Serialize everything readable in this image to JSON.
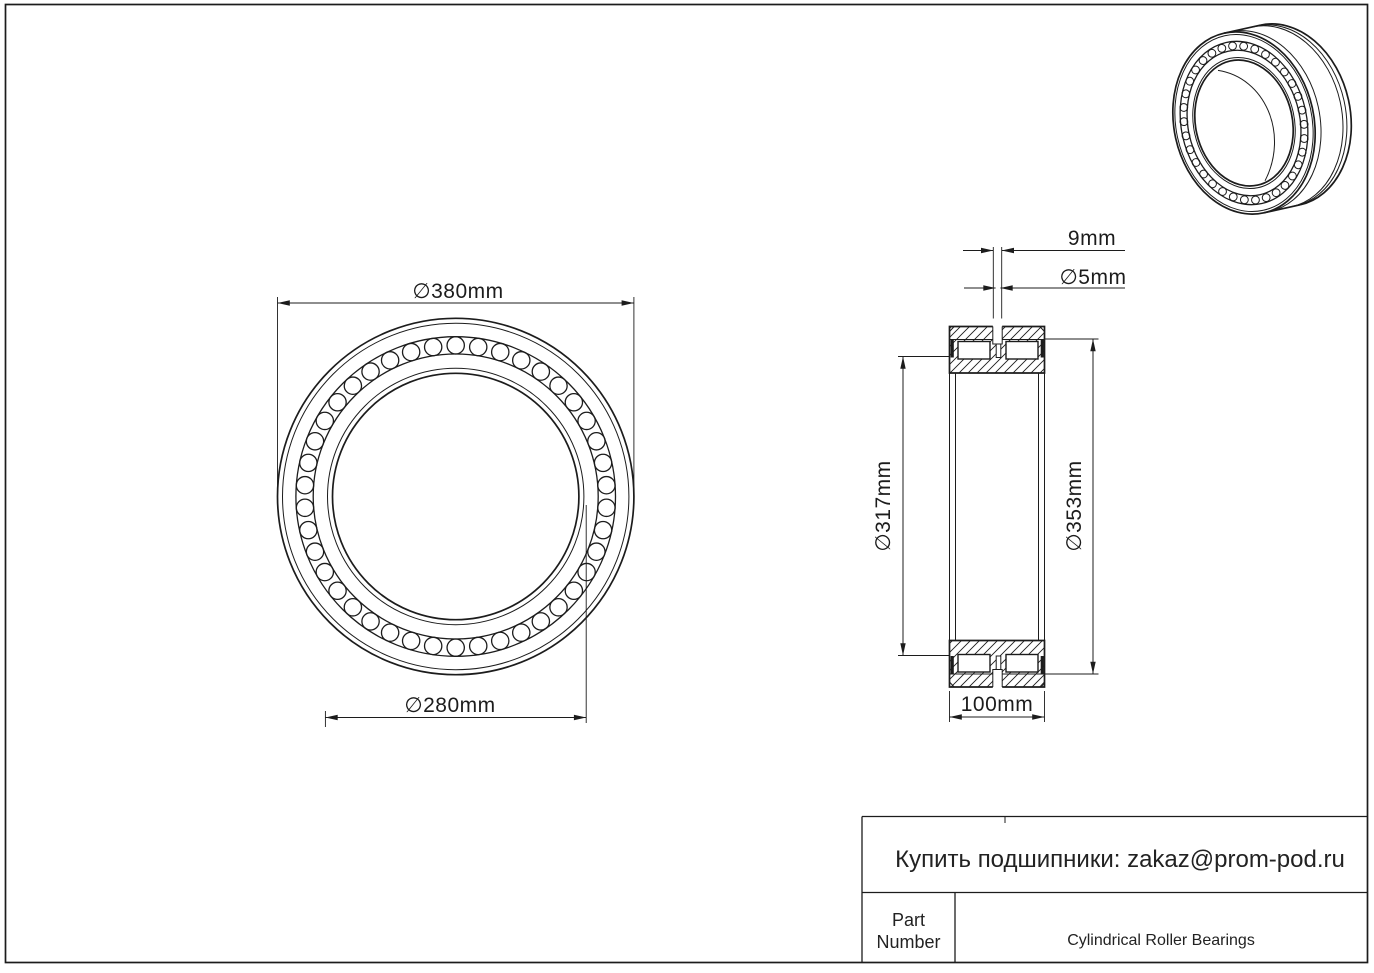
{
  "dims": {
    "outer_d": "∅380mm",
    "bore_d": "∅280mm",
    "groove_w": "9mm",
    "hole_d": "∅5mm",
    "raceway_inner_d": "∅317mm",
    "raceway_outer_d": "∅353mm",
    "width": "100mm"
  },
  "title_block": {
    "contact": "Купить подшипники: zakaz@prom-pod.ru",
    "part_line1": "Part",
    "part_line2": "Number",
    "type": "Cylindrical Roller Bearings"
  },
  "colors": {
    "line": "#1c1c1c",
    "background": "#ffffff"
  }
}
